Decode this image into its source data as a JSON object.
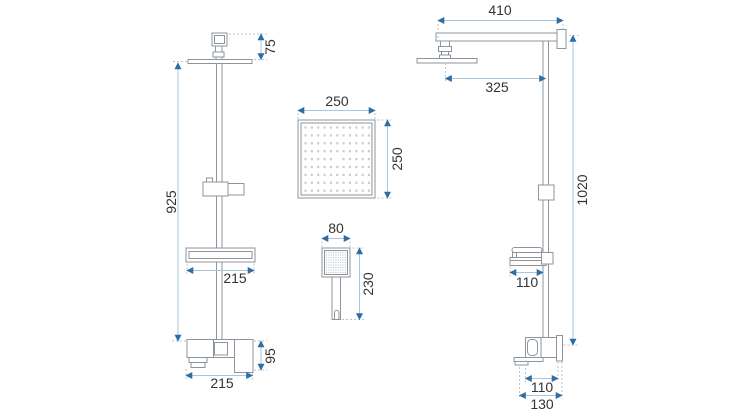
{
  "colors": {
    "dimension_line": "#a9c6da",
    "dimension_arrow": "#2f6ea5",
    "extension_line": "#b9c6ce",
    "outline": "#8d949b",
    "label_text": "#333333",
    "nozzle_dots": "#c9ced3",
    "background": "#ffffff"
  },
  "front_view": {
    "head_wall_offset": "75",
    "column_height": "925",
    "shelf_width": "215",
    "mixer_height": "95",
    "mixer_width": "215"
  },
  "head_top_view": {
    "width": "250",
    "depth": "250"
  },
  "hand_shower_view": {
    "width": "80",
    "length": "230"
  },
  "side_view": {
    "arm_length": "410",
    "arm_reach": "325",
    "column_length": "1020",
    "shelf_depth": "110",
    "mixer_depth": "110",
    "mixer_total_depth": "130"
  }
}
